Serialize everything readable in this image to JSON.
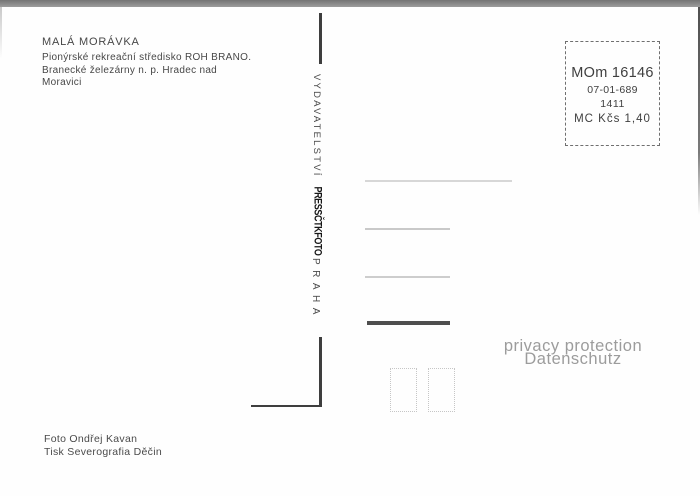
{
  "sender": {
    "title": "MALÁ MORÁVKA",
    "lines": [
      "Pionýrské rekreační středisko ROH BRANO.",
      "Branecké železárny n. p. Hradec nad",
      "Moravici"
    ]
  },
  "publisher": {
    "name": "VYDAVATELSTVÍ",
    "logo": "PRESSČTKFOTO",
    "city": "PRAHA"
  },
  "stamp": {
    "code": "MOm 16146",
    "number": "07-01-689",
    "year": "1411",
    "price": "MC Kčs 1,40"
  },
  "credits": {
    "photo": "Foto Ondřej Kavan",
    "print": "Tisk Severografia Děčin"
  },
  "watermark": {
    "line1": "privacy protection",
    "line2": "Datenschutz"
  },
  "colors": {
    "ink": "#474747",
    "watermark": "#9c9c9c",
    "rule_dark": "#4e4e4e",
    "rule_light": "#d7d7d7",
    "divider": "#3e3e3e"
  }
}
